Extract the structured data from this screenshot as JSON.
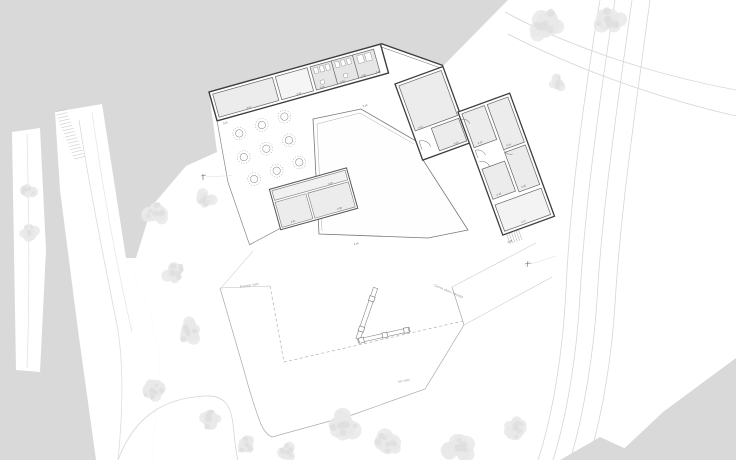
{
  "annotations": {
    "plaza_area": "Prostor vasi",
    "village_road": "Cesta skozi naselje",
    "garden_area": "Vrt vasi"
  },
  "room_tags": [
    "0.01",
    "0.02",
    "0.03",
    "0.04",
    "0.05",
    "0.06",
    "0.07",
    "0.08",
    "0.09",
    "0.10",
    "0.11",
    "0.12",
    "0.13",
    "0.14",
    "0.15",
    "0.16",
    "0.17",
    "0.18",
    "0.19",
    "0.20"
  ],
  "colors": {
    "background": "#d9d9d9",
    "paper": "#ffffff",
    "room_fill": "#ececec",
    "sanitary_fill": "#e6e6e6",
    "wall_line": "#3d3d3d",
    "partition_line": "#666666",
    "boundary_line": "#aaaaaa",
    "faint_line": "#d6d6d6",
    "tree_fill": "#e9e9e9",
    "tag_text": "#555555"
  }
}
